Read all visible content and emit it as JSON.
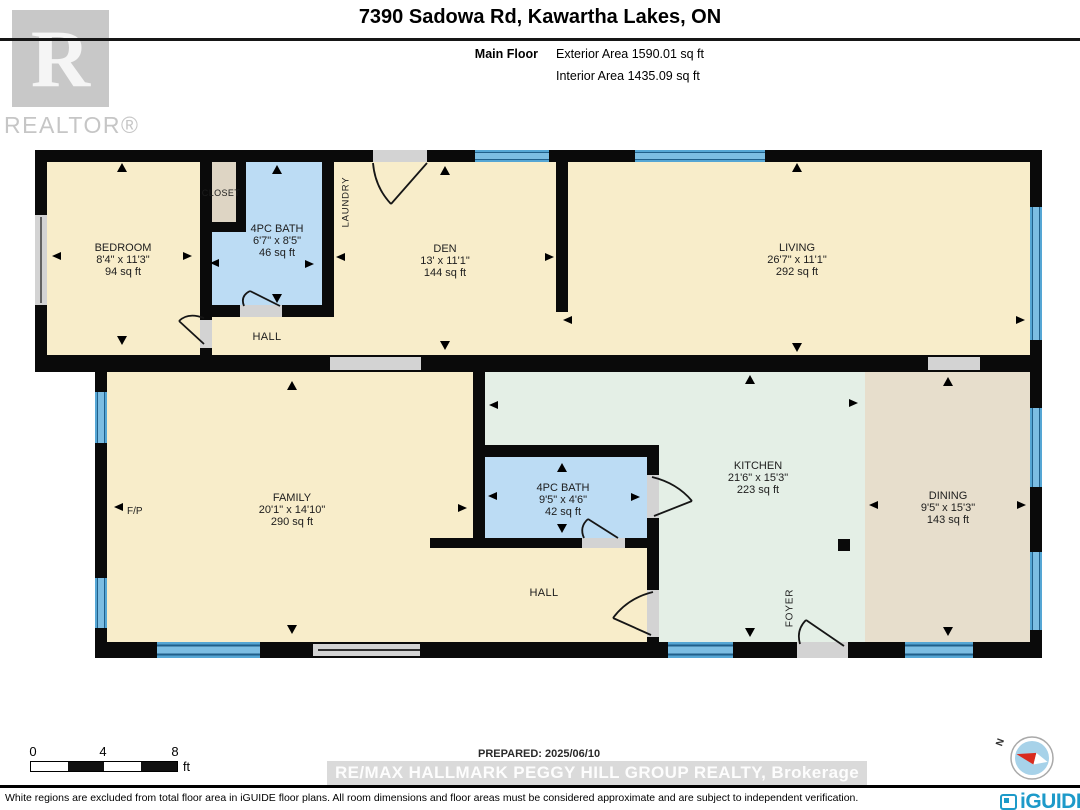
{
  "header": {
    "title": "7390 Sadowa Rd, Kawartha Lakes, ON",
    "floor_label": "Main Floor",
    "exterior_area": "Exterior Area 1590.01 sq ft",
    "interior_area": "Interior Area 1435.09 sq ft"
  },
  "branding": {
    "realtor_letter": "R",
    "realtor_word": "REALTOR®",
    "iguide_word": "iGUIDE"
  },
  "rooms": [
    {
      "name": "BEDROOM",
      "dims": "8'4\" x 11'3\"",
      "area": "94 sq ft"
    },
    {
      "name": "4PC BATH",
      "dims": "6'7\" x 8'5\"",
      "area": "46 sq ft"
    },
    {
      "name": "DEN",
      "dims": "13' x 11'1\"",
      "area": "144 sq ft"
    },
    {
      "name": "LIVING",
      "dims": "26'7\" x 11'1\"",
      "area": "292 sq ft"
    },
    {
      "name": "FAMILY",
      "dims": "20'1\" x 14'10\"",
      "area": "290 sq ft"
    },
    {
      "name": "4PC BATH",
      "dims": "9'5\" x 4'6\"",
      "area": "42 sq ft"
    },
    {
      "name": "KITCHEN",
      "dims": "21'6\" x 15'3\"",
      "area": "223 sq ft"
    },
    {
      "name": "DINING",
      "dims": "9'5\" x 15'3\"",
      "area": "143 sq ft"
    }
  ],
  "labels": {
    "closet": "CLOSET",
    "laundry": "LAUNDRY",
    "hall_upper": "HALL",
    "hall_lower": "HALL",
    "foyer": "FOYER",
    "fireplace": "F/P"
  },
  "footer": {
    "scale_ticks": [
      "0",
      "4",
      "8"
    ],
    "scale_unit": "ft",
    "prepared": "PREPARED: 2025/06/10",
    "watermark": "RE/MAX HALLMARK PEGGY HILL GROUP REALTY, Brokerage",
    "compass_north": "N",
    "disclaimer": "White regions are excluded from total floor area in iGUIDE floor plans. All room dimensions and floor areas must be considered approximate and are subject to independent verification."
  },
  "colors": {
    "room_cream": "#f8edca",
    "bath_blue": "#bcdcf4",
    "closet_tan": "#ded5c4",
    "kitchen_mint": "#e4efe6",
    "dining_tan": "#e7decc",
    "window_blue": "#55a6d4",
    "wall_black": "#0a0a0a",
    "opening_gray": "#d3d3d3",
    "iguide_teal": "#1d9ac9"
  }
}
